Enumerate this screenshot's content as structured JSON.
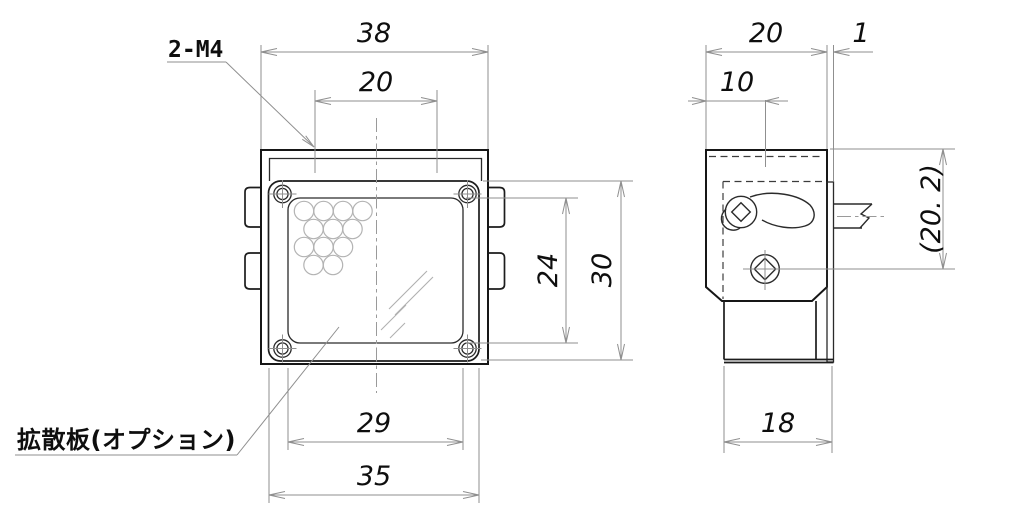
{
  "colors": {
    "background": "#ffffff",
    "outline": "#161616",
    "dimension_line": "#8f8f8f",
    "led_circle": "#b3b3b3"
  },
  "annotations": {
    "mounting_holes_label": "2-M4",
    "diffusion_plate_label": "拡散板(オプション)"
  },
  "front_view": {
    "overall_width": "38",
    "mount_hole_pitch": "20",
    "window_height": "24",
    "faceplate_height": "30",
    "window_width": "29",
    "faceplate_width": "35"
  },
  "side_view": {
    "body_depth": "20",
    "plate_thickness": "1",
    "mount_hole_offset": "10",
    "lower_body_width": "18",
    "reference_height": "(20. 2)"
  }
}
